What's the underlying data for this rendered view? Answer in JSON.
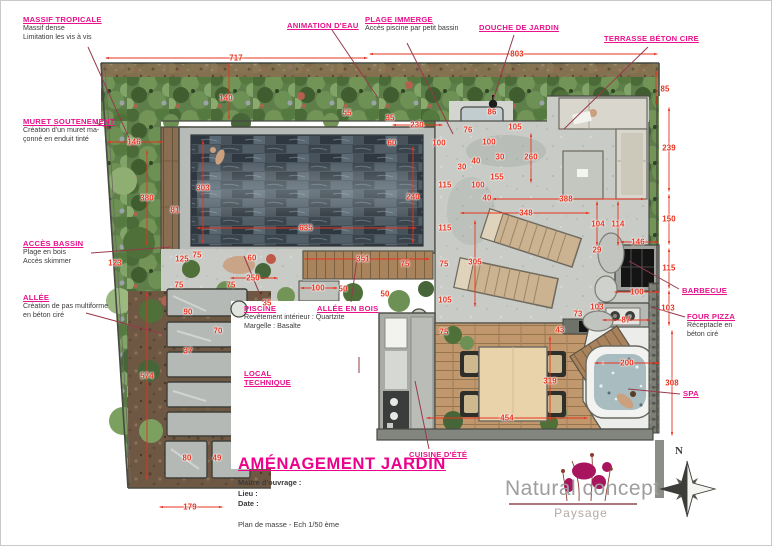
{
  "colors": {
    "label_pink": "#e9118c",
    "dimension_red": "#e8331f",
    "leader_maroon": "#963a4a",
    "foliage_green": "#5e7f49",
    "pool_slate": "#46525c",
    "concrete_grey": "#c9cbc6",
    "deck_wood": "#c1986d"
  },
  "callouts": [
    {
      "id": "massif-tropicale",
      "x": 22,
      "y": 14,
      "title": [
        "MASSIF TROPICALE"
      ],
      "sub": [
        "Massif dense",
        "Limitation les vis à vis"
      ],
      "leader": [
        87,
        46,
        133,
        148
      ]
    },
    {
      "id": "animation-eau",
      "x": 286,
      "y": 20,
      "title": [
        "ANIMATION D'EAU"
      ],
      "sub": [],
      "leader": [
        331,
        29,
        377,
        97
      ]
    },
    {
      "id": "plage-immergee",
      "x": 364,
      "y": 14,
      "title": [
        "PLAGE IMMERGE"
      ],
      "sub": [
        "Accès piscine par petit bassin"
      ],
      "leader": [
        406,
        42,
        452,
        133
      ]
    },
    {
      "id": "douche-de-jardin",
      "x": 478,
      "y": 22,
      "title": [
        "DOUCHE DE JARDIN"
      ],
      "sub": [],
      "leader": [
        513,
        34,
        492,
        99
      ]
    },
    {
      "id": "terrasse-beton-cire",
      "x": 603,
      "y": 33,
      "title": [
        "TERRASSE BÉTON CIRE"
      ],
      "sub": [],
      "leader": [
        647,
        46,
        563,
        128
      ]
    },
    {
      "id": "muret-soutenement",
      "x": 22,
      "y": 116,
      "title": [
        "MURET SOUTENEMENT"
      ],
      "sub": [
        "Création d'un muret ma-",
        "çonné en enduit tinté"
      ],
      "leader": [
        95,
        122,
        110,
        128
      ]
    },
    {
      "id": "acces-bassin",
      "x": 22,
      "y": 238,
      "title": [
        "ACCÈS BASSIN"
      ],
      "sub": [
        "Plage en bois",
        "Accès skimmer"
      ],
      "leader": [
        90,
        252,
        170,
        246
      ]
    },
    {
      "id": "allee",
      "x": 22,
      "y": 292,
      "title": [
        "ALLÉE"
      ],
      "sub": [
        "Création de pas multiforme",
        "en béton ciré"
      ],
      "leader": [
        85,
        312,
        162,
        333
      ]
    },
    {
      "id": "piscine",
      "x": 243,
      "y": 303,
      "title": [
        "PISCINE"
      ],
      "sub": [
        "Revêtement intérieur : Quartzite",
        "Margelle : Basalte"
      ],
      "leader": [
        262,
        301,
        243,
        255
      ]
    },
    {
      "id": "allee-en-bois",
      "x": 316,
      "y": 303,
      "title": [
        "ALLÉE EN BOIS"
      ],
      "sub": [],
      "leader": [
        350,
        301,
        356,
        258
      ]
    },
    {
      "id": "local-technique",
      "x": 243,
      "y": 368,
      "title": [
        "LOCAL",
        "TECHNIQUE"
      ],
      "sub": [],
      "leader": [
        358,
        356,
        358,
        372
      ]
    },
    {
      "id": "barbecue",
      "x": 681,
      "y": 285,
      "title": [
        "BARBECUE"
      ],
      "sub": [],
      "leader": [
        678,
        288,
        628,
        260
      ]
    },
    {
      "id": "four-pizza",
      "x": 686,
      "y": 311,
      "title": [
        "FOUR PIZZA"
      ],
      "sub": [
        "Réceptacle en",
        "béton ciré"
      ],
      "leader": [
        684,
        316,
        650,
        306
      ]
    },
    {
      "id": "spa",
      "x": 682,
      "y": 388,
      "title": [
        "SPA"
      ],
      "sub": [],
      "leader": [
        679,
        393,
        627,
        388
      ]
    },
    {
      "id": "cuisine-ete",
      "x": 408,
      "y": 449,
      "title": [
        "CUISINE D'ÉTÉ"
      ],
      "sub": [],
      "leader": [
        428,
        448,
        414,
        380
      ]
    }
  ],
  "dimensions": [
    [
      717,
      235,
      57
    ],
    [
      803,
      516,
      53
    ],
    [
      85,
      664,
      88
    ],
    [
      140,
      225,
      97
    ],
    [
      146,
      133,
      141
    ],
    [
      380,
      146,
      197
    ],
    [
      303,
      202,
      187
    ],
    [
      81,
      174,
      209
    ],
    [
      635,
      305,
      227
    ],
    [
      240,
      412,
      196
    ],
    [
      55,
      346,
      112
    ],
    [
      35,
      389,
      117
    ],
    [
      230,
      416,
      124
    ],
    [
      60,
      391,
      142
    ],
    [
      100,
      438,
      142
    ],
    [
      76,
      467,
      129
    ],
    [
      86,
      491,
      111
    ],
    [
      100,
      488,
      141
    ],
    [
      105,
      514,
      126
    ],
    [
      30,
      499,
      156
    ],
    [
      260,
      530,
      156
    ],
    [
      40,
      475,
      160
    ],
    [
      30,
      461,
      166
    ],
    [
      155,
      496,
      176
    ],
    [
      100,
      477,
      184
    ],
    [
      40,
      486,
      197
    ],
    [
      115,
      444,
      184
    ],
    [
      115,
      444,
      227
    ],
    [
      75,
      443,
      263
    ],
    [
      105,
      444,
      299
    ],
    [
      388,
      565,
      198
    ],
    [
      348,
      525,
      212
    ],
    [
      305,
      474,
      261
    ],
    [
      104,
      597,
      223
    ],
    [
      114,
      617,
      223
    ],
    [
      146,
      637,
      241
    ],
    [
      29,
      596,
      249
    ],
    [
      239,
      668,
      147
    ],
    [
      150,
      668,
      218
    ],
    [
      115,
      668,
      267
    ],
    [
      100,
      636,
      291
    ],
    [
      103,
      596,
      306
    ],
    [
      103,
      667,
      307
    ],
    [
      87,
      625,
      319
    ],
    [
      73,
      577,
      313
    ],
    [
      43,
      559,
      329
    ],
    [
      200,
      626,
      362
    ],
    [
      308,
      671,
      382
    ],
    [
      319,
      549,
      380
    ],
    [
      454,
      506,
      417
    ],
    [
      75,
      443,
      331
    ],
    [
      351,
      362,
      258
    ],
    [
      75,
      404,
      263
    ],
    [
      100,
      317,
      287
    ],
    [
      50,
      342,
      288
    ],
    [
      50,
      384,
      293
    ],
    [
      35,
      266,
      302
    ],
    [
      60,
      251,
      257
    ],
    [
      250,
      252,
      277
    ],
    [
      125,
      181,
      258
    ],
    [
      123,
      114,
      262
    ],
    [
      75,
      196,
      254
    ],
    [
      75,
      178,
      284
    ],
    [
      75,
      230,
      284
    ],
    [
      90,
      187,
      311
    ],
    [
      70,
      217,
      330
    ],
    [
      37,
      187,
      350
    ],
    [
      574,
      146,
      375
    ],
    [
      80,
      186,
      457
    ],
    [
      49,
      216,
      457
    ],
    [
      179,
      189,
      506
    ]
  ],
  "dimension_lines": [
    [
      105,
      57,
      366,
      57
    ],
    [
      369,
      53,
      656,
      53
    ],
    [
      655,
      70,
      655,
      103
    ],
    [
      228,
      63,
      228,
      118
    ],
    [
      107,
      141,
      161,
      141
    ],
    [
      146,
      150,
      146,
      244
    ],
    [
      146,
      292,
      146,
      478
    ],
    [
      202,
      140,
      202,
      242
    ],
    [
      196,
      227,
      415,
      227
    ],
    [
      412,
      146,
      412,
      242
    ],
    [
      492,
      198,
      643,
      198
    ],
    [
      460,
      212,
      588,
      212
    ],
    [
      474,
      220,
      474,
      305
    ],
    [
      304,
      258,
      428,
      258
    ],
    [
      549,
      336,
      549,
      420
    ],
    [
      426,
      417,
      586,
      417
    ],
    [
      594,
      362,
      658,
      362
    ],
    [
      671,
      330,
      671,
      434
    ],
    [
      668,
      107,
      668,
      190
    ],
    [
      668,
      194,
      668,
      243
    ],
    [
      668,
      248,
      668,
      287
    ],
    [
      668,
      290,
      668,
      324
    ],
    [
      159,
      506,
      221,
      506
    ],
    [
      392,
      124,
      441,
      124
    ],
    [
      530,
      133,
      530,
      181
    ],
    [
      596,
      201,
      596,
      244
    ],
    [
      617,
      201,
      617,
      244
    ],
    [
      614,
      291,
      658,
      291
    ],
    [
      602,
      319,
      649,
      319
    ],
    [
      230,
      277,
      276,
      277
    ],
    [
      300,
      287,
      336,
      287
    ],
    [
      620,
      241,
      657,
      241
    ]
  ],
  "title_block": {
    "title": "AMÉNAGEMENT JARDIN",
    "fields": [
      "Maître d'ouvrage :",
      "Lieu :",
      "Date :"
    ],
    "note": "Plan de masse - Ech 1/50 ème"
  },
  "logo": {
    "name": "Natural concept",
    "tagline": "Paysage"
  },
  "compass": {
    "north_label": "N"
  }
}
